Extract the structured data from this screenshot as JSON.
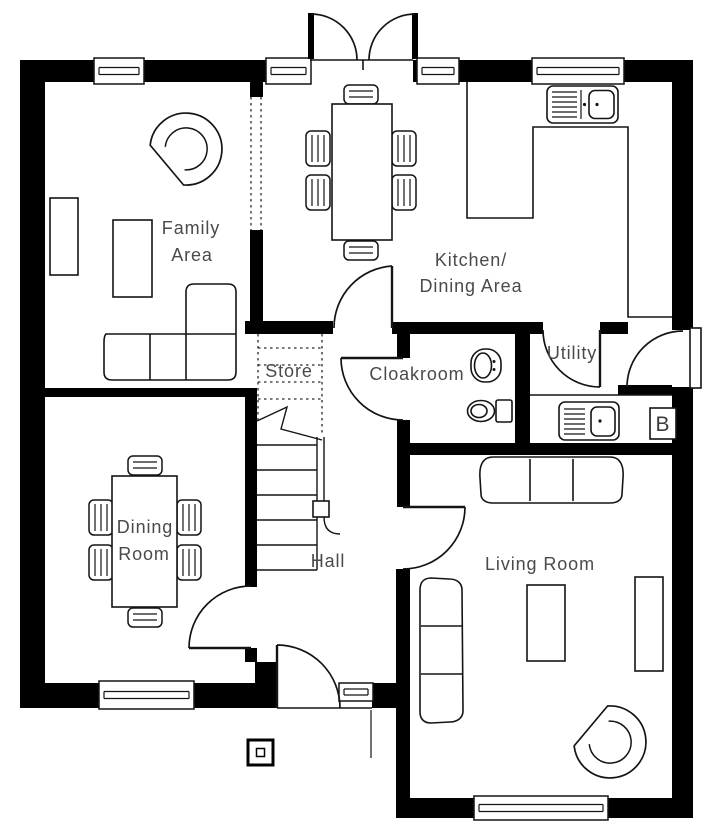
{
  "colors": {
    "wall": "#000000",
    "line": "#141414",
    "label": "#4a4a4a",
    "background": "#ffffff"
  },
  "rooms": {
    "family_area": {
      "line1": "Family",
      "line2": "Area"
    },
    "kitchen_dining": {
      "line1": "Kitchen/",
      "line2": "Dining Area"
    },
    "store": {
      "label": "Store"
    },
    "cloakroom": {
      "label": "Cloakroom"
    },
    "utility": {
      "label": "Utility"
    },
    "dining_room": {
      "line1": "Dining",
      "line2": "Room"
    },
    "hall": {
      "label": "Hall"
    },
    "living_room": {
      "label": "Living Room"
    },
    "boiler": {
      "label": "B"
    }
  }
}
